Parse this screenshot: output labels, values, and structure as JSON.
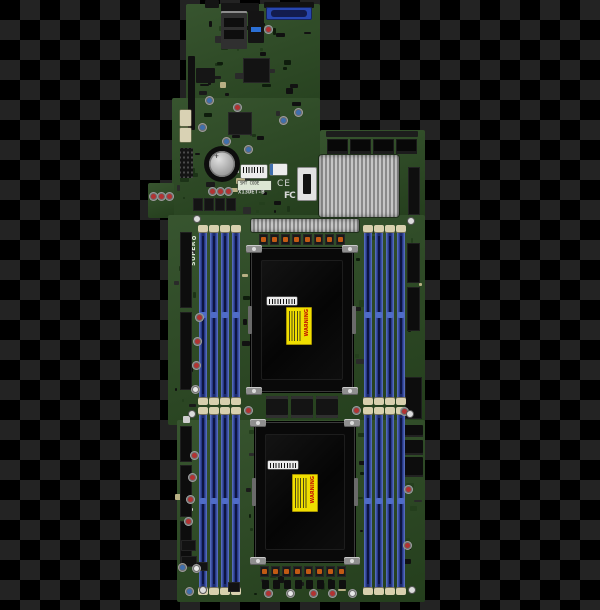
{
  "labels": {
    "brand_vertical": "SUPER",
    "model": "X13DET-B",
    "smt_code": "SMT CODE",
    "ce_mark": "CE",
    "fcc_mark": "FC",
    "warning": "WARNING",
    "battery_polarity": "+"
  },
  "colors": {
    "background_checker_dark": "#000000",
    "background_checker_light": "#232323",
    "pcb_green": "#2b4a22",
    "pcb_green_light": "#33562a",
    "dimm_blue": "#2a3c8e",
    "dimm_blue_light": "#6078c8",
    "dimm_blue_dark": "#16245c",
    "dimm_latch_cream": "#d8d0ae",
    "socket_black": "#090909",
    "heatsink_silver": "#bdbdbd",
    "warning_yellow": "#f0df00",
    "warning_red": "#c41000",
    "choke_orange": "#c25a14",
    "cap_red": "#b23232",
    "cap_blue": "#3f6fae",
    "cap_white": "#e8e8e8",
    "vga_blue": "#2847b0",
    "usb_blue": "#2b6fd4",
    "connector_black": "#0d0d0d",
    "metal_tab": "#8f8f8f"
  },
  "board": {
    "cpu_sockets": 2,
    "dimm_banks": 4,
    "dimm_slots_per_bank": 4,
    "dimm_slots_total": 16,
    "vrm_chokes_per_row": 8,
    "riser_connectors": 4,
    "vrm_modules_between_sockets": 3
  }
}
